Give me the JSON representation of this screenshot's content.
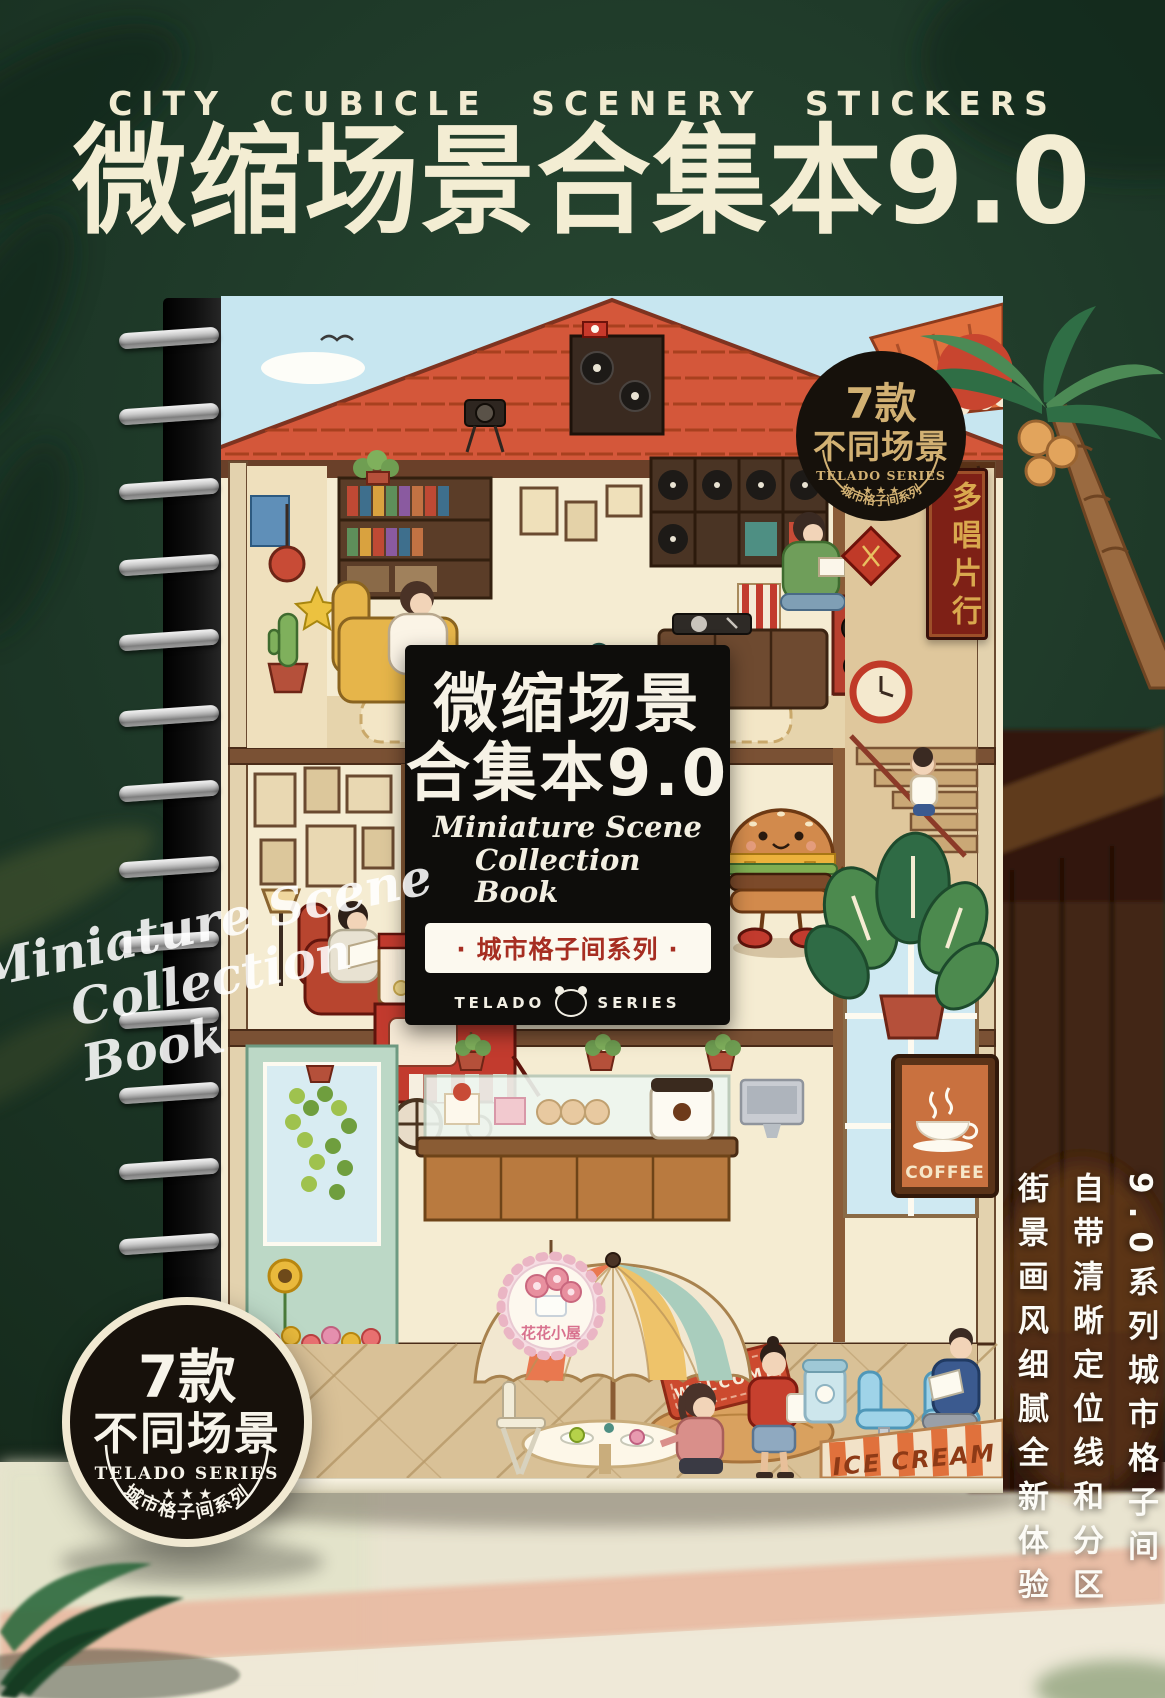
{
  "page": {
    "header_small": "CITY CUBICLE SCENERY STICKERS",
    "header_title": "微缩场景合集本9.0"
  },
  "watermark": {
    "line1": "Miniature Scene",
    "line2": "Collection Book"
  },
  "book": {
    "label": {
      "title_line1": "微缩场景",
      "title_line2": "合集本9.0",
      "script_line1": "Miniature Scene",
      "script_line2": "Collection Book",
      "series_band": "· 城市格子间系列 ·",
      "brand_left": "TELADO",
      "brand_right": "SERIES"
    },
    "cover_signs": {
      "record_shop": "多唱片行",
      "coffee": "COFFEE",
      "flower_shop": "花花小屋",
      "welcome_mat": "WELCOME",
      "ice_cream": "ICE CREAM"
    }
  },
  "badge_top_right": {
    "count": "7款",
    "scenes": "不同场景",
    "brand": "TELADO SERIES",
    "stars": "★ ★ ★",
    "series": "城市格子间系列"
  },
  "badge_bottom_left": {
    "count": "7款",
    "scenes": "不同场景",
    "brand": "TELADO SERIES",
    "stars": "★ ★ ★",
    "series": "城市格子间系列"
  },
  "right_panel": {
    "col1": "9.0系列城市格子间",
    "col2": "自带清晰定位线和分区",
    "col3": "街景画风细腻全新体验"
  },
  "colors": {
    "background_green": "#1d3727",
    "cream_text": "#f3edd3",
    "label_black": "#0e0d0b",
    "series_red": "#a62e22",
    "badge_gold": "#d2b173",
    "roof_red": "#d4573a",
    "floor": "#e9e4d0",
    "floor_stripe": "#e9bca4"
  }
}
